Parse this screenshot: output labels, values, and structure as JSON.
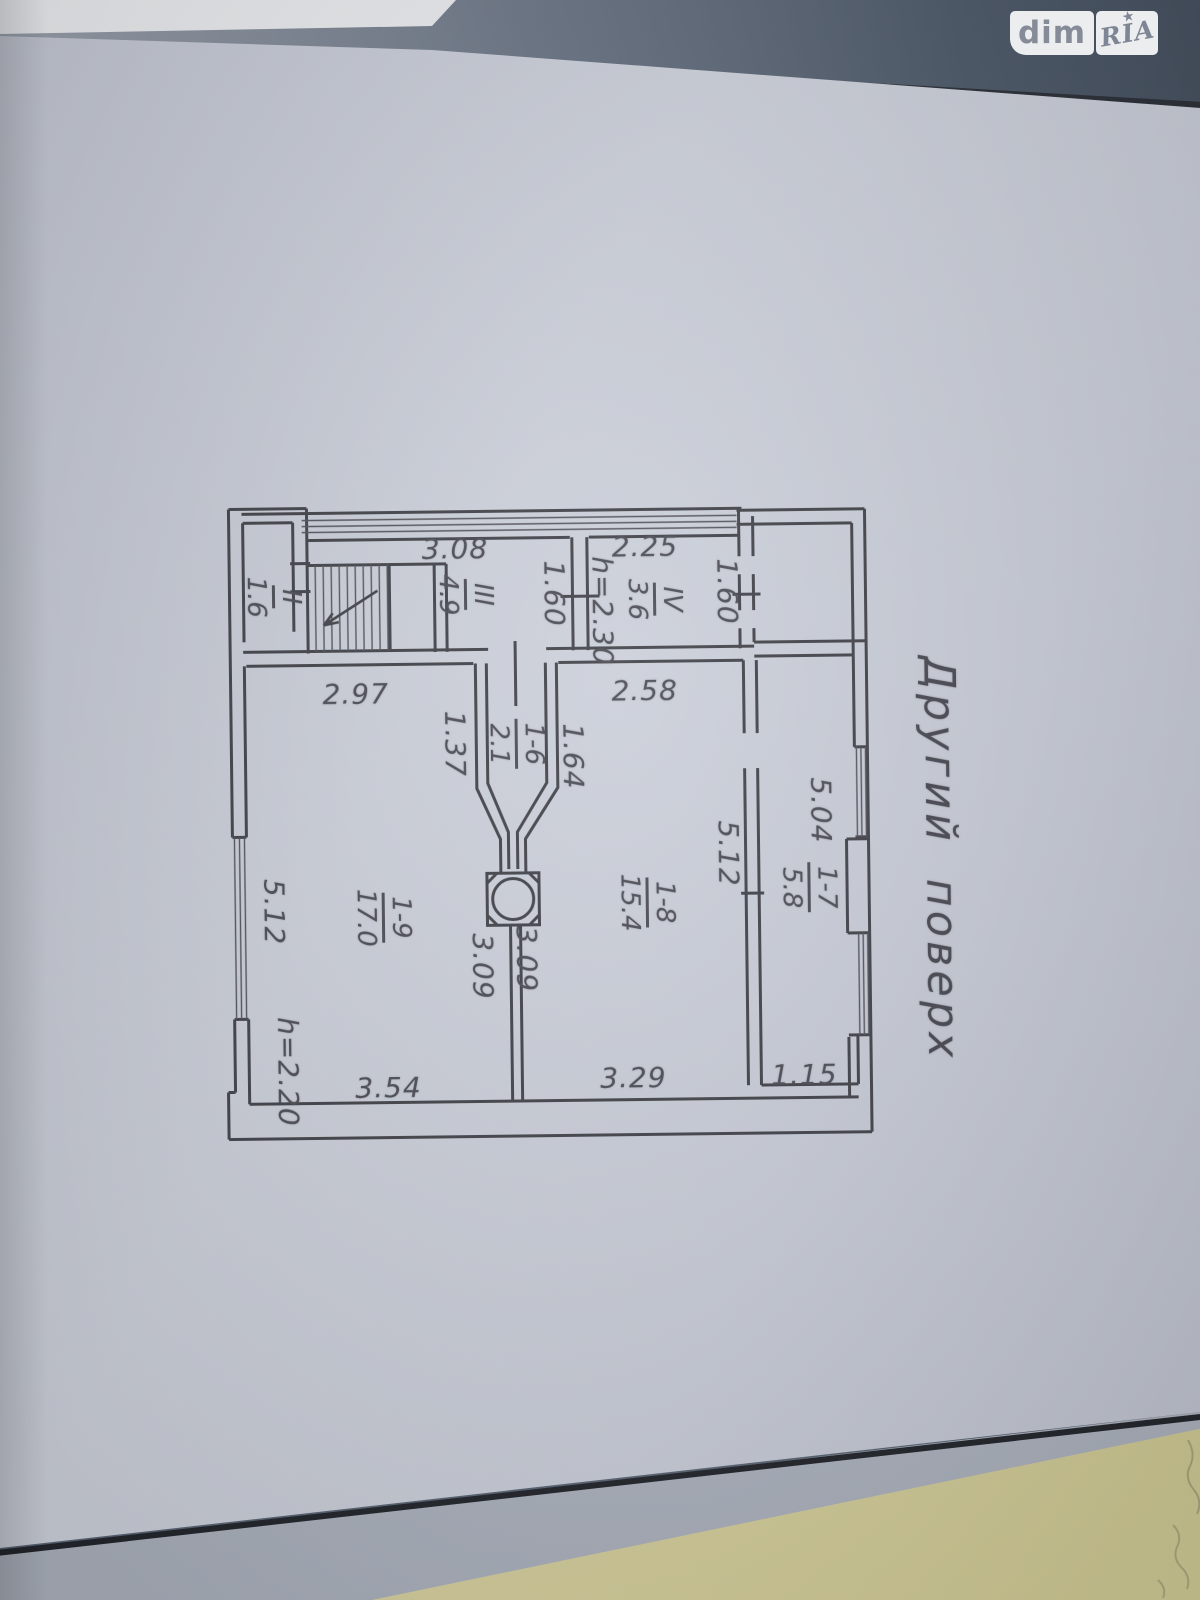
{
  "watermark": {
    "dim": "dim",
    "ria": "RIA",
    "star": "★"
  },
  "title": "Другий поверх",
  "plan": {
    "dims": {
      "d308": "3.08",
      "d225": "2.25",
      "d160a": "1.60",
      "d160b": "1.60",
      "h230": "h=2.30",
      "d297": "2.97",
      "d258": "2.58",
      "d137": "1.37",
      "d164": "1.64",
      "d504": "5.04",
      "d512a": "5.12",
      "d512b": "5.12",
      "d309a": "3.09",
      "d309b": "3.09",
      "d329": "3.29",
      "d115": "1.15",
      "d354": "3.54",
      "h220": "h=2.20"
    },
    "rooms": {
      "r2": {
        "num": "II",
        "area": "1.6"
      },
      "r3": {
        "num": "III",
        "area": "4.9"
      },
      "r4": {
        "num": "IV",
        "area": "3.6"
      },
      "r16": {
        "num": "1-6",
        "area": "2.1"
      },
      "r17": {
        "num": "1-7",
        "area": "5.8"
      },
      "r18": {
        "num": "1-8",
        "area": "15.4"
      },
      "r19": {
        "num": "1-9",
        "area": "17.0"
      }
    }
  },
  "colors": {
    "paper": "#c9cdd8",
    "ink": "#43434b",
    "second_sheet": "#d6d0a2"
  }
}
